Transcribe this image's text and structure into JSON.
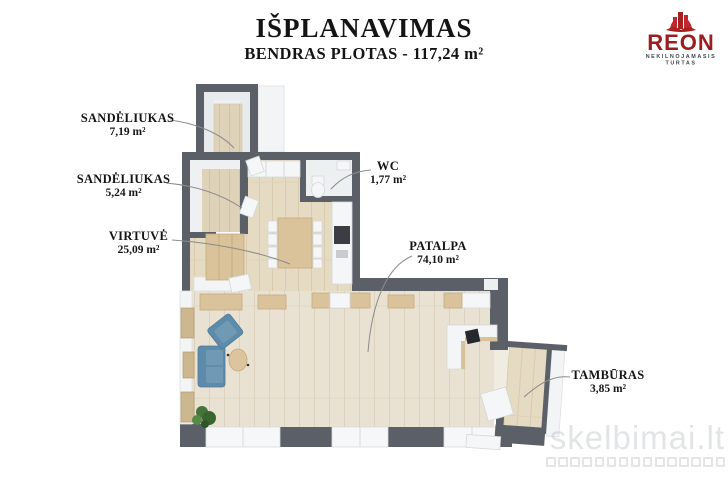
{
  "header": {
    "title": "IŠPLANAVIMAS",
    "subtitle": "BENDRAS PLOTAS - 117,24 m²"
  },
  "logo": {
    "name": "REON",
    "tagline1": "NEKILNOJAMASIS",
    "tagline2": "TURTAS"
  },
  "rooms": [
    {
      "name": "SANDĖLIUKAS",
      "area": "7,19 m²"
    },
    {
      "name": "SANDĖLIUKAS",
      "area": "5,24 m²"
    },
    {
      "name": "VIRTUVĖ",
      "area": "25,09 m²"
    },
    {
      "name": "WC",
      "area": "1,77 m²"
    },
    {
      "name": "PATALPA",
      "area": "74,10 m²"
    },
    {
      "name": "TAMBŪRAS",
      "area": "3,85 m²"
    }
  ],
  "watermark": {
    "text": "skelbimai.lt"
  },
  "colors": {
    "wall": "#5b6068",
    "floor_main": "#e9e1d1",
    "floor_kitchen": "#e5dac2",
    "floor_small": "#ded2b8",
    "sofa": "#5f8baa",
    "wood": "#dac29a",
    "logo_red": "#a6211f",
    "label": "#151515"
  }
}
